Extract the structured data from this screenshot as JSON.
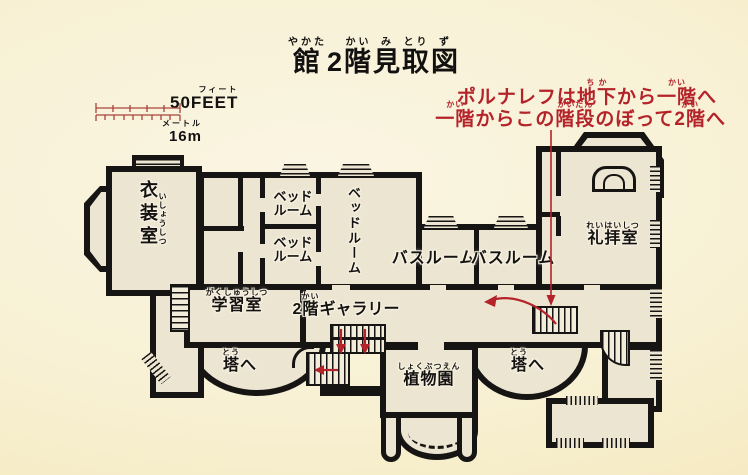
{
  "colors": {
    "background": "#f8f1d5",
    "wall": "#171513",
    "room_fill": "#ece5d1",
    "accent_red": "#b4232a"
  },
  "title": {
    "segments": [
      {
        "furi": "やかた",
        "base": "館"
      },
      {
        "furi": "",
        "base": "2"
      },
      {
        "furi": "かい",
        "base": "階"
      },
      {
        "furi": "み",
        "base": "見"
      },
      {
        "furi": "とり",
        "base": "取"
      },
      {
        "furi": "ず",
        "base": "図"
      }
    ]
  },
  "annotation": {
    "line1": [
      {
        "furi": "",
        "base": "ポルナレフは"
      },
      {
        "furi": "ち か",
        "base": "地下"
      },
      {
        "furi": "",
        "base": "から"
      },
      {
        "furi": "かい",
        "base": "一階"
      },
      {
        "furi": "",
        "base": "へ"
      }
    ],
    "line2": [
      {
        "furi": "かい",
        "base": "一階"
      },
      {
        "furi": "",
        "base": "からこの"
      },
      {
        "furi": "かいだん",
        "base": "階段"
      },
      {
        "furi": "",
        "base": "のぼって"
      },
      {
        "furi": "かい",
        "base": "2階"
      },
      {
        "furi": "",
        "base": "へ"
      }
    ]
  },
  "scale": {
    "feet_furigana": "フィート",
    "feet_label": "50FEET",
    "meters_furigana": "メートル",
    "meters_label": "16m"
  },
  "rooms": {
    "wardrobe": {
      "label": "衣装室",
      "furigana": "いしょうしつ"
    },
    "bedroom_small_top": {
      "line1": "ベッド",
      "line2": "ルーム"
    },
    "bedroom_small_bottom": {
      "line1": "ベッド",
      "line2": "ルーム"
    },
    "bedroom_large": {
      "label": "ベッドルーム"
    },
    "bathroom_left": {
      "label": "バスルーム"
    },
    "bathroom_right": {
      "label": "バスルーム"
    },
    "chapel": {
      "label": "礼拝室",
      "furigana": "れいはいしつ"
    },
    "study": {
      "label": "学習室",
      "furigana": "がくしゅうしつ"
    },
    "gallery": {
      "segments": [
        {
          "furi": "",
          "base": "2"
        },
        {
          "furi": "かい",
          "base": "階"
        },
        {
          "furi": "",
          "base": "ギャラリー"
        }
      ]
    },
    "tower_left": {
      "segments": [
        {
          "furi": "とう",
          "base": "塔"
        },
        {
          "furi": "",
          "base": "へ"
        }
      ]
    },
    "tower_right": {
      "segments": [
        {
          "furi": "とう",
          "base": "塔"
        },
        {
          "furi": "",
          "base": "へ"
        }
      ]
    },
    "garden": {
      "label": "植物園",
      "furigana": "しょくぶつえん"
    }
  }
}
